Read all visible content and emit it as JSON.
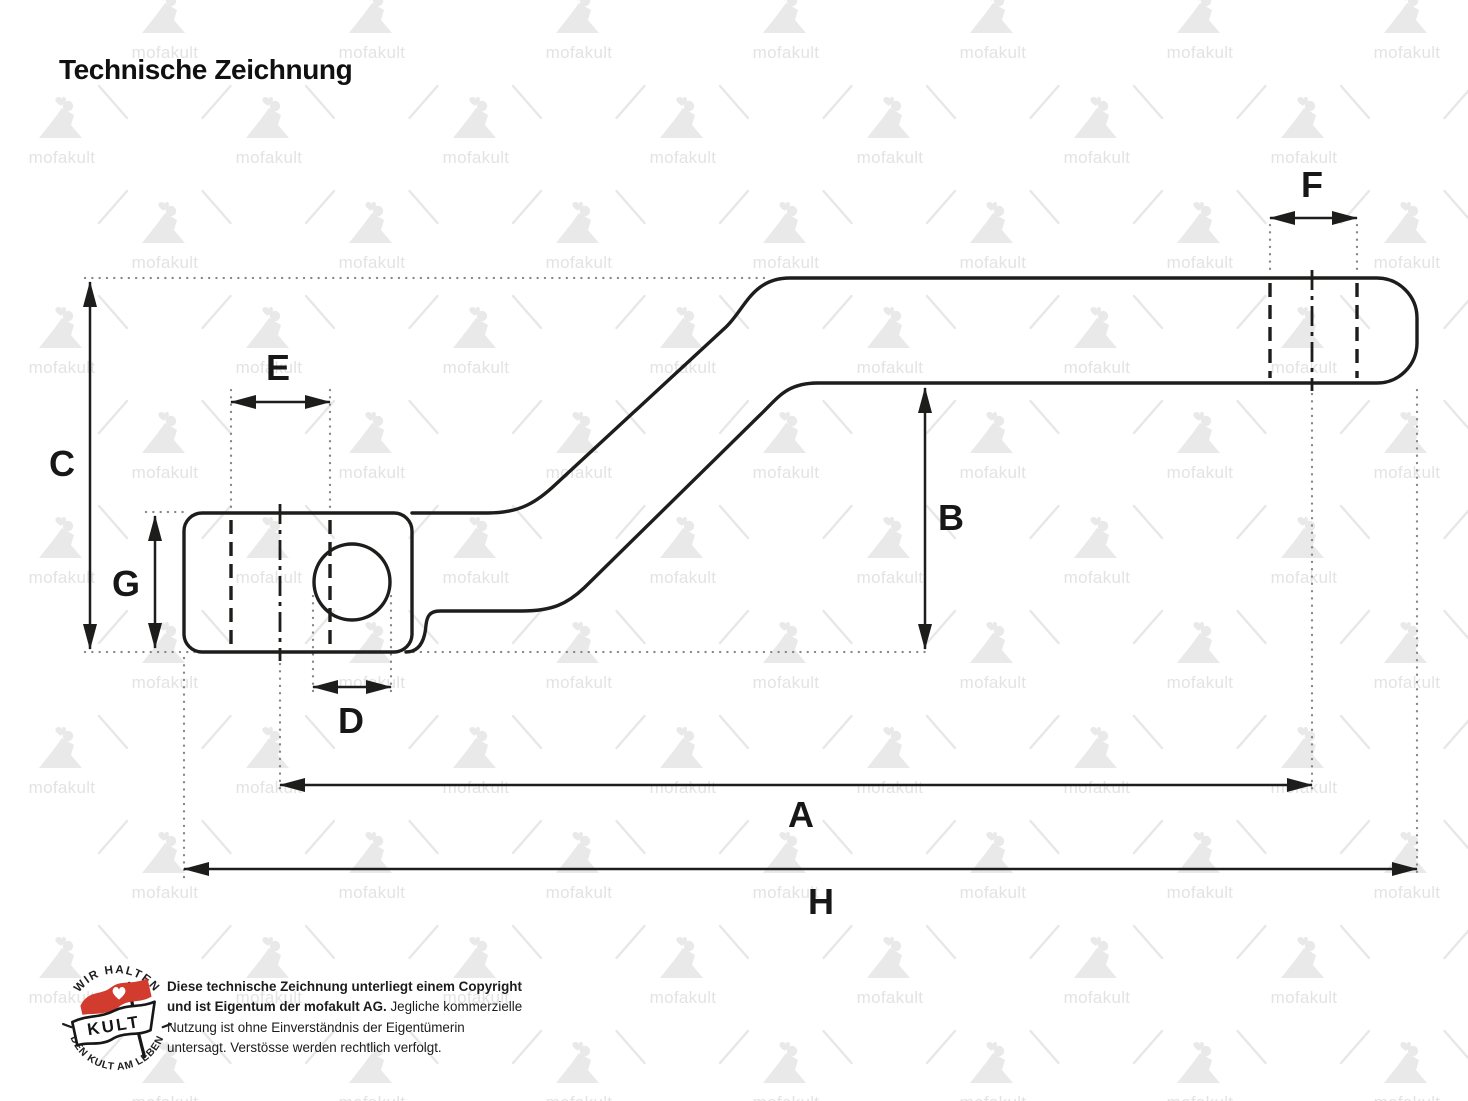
{
  "title": "Technische Zeichnung",
  "watermark": {
    "text": "mofakult"
  },
  "dims": {
    "A": "A",
    "B": "B",
    "C": "C",
    "D": "D",
    "E": "E",
    "F": "F",
    "G": "G",
    "H": "H"
  },
  "badge": {
    "top": "WIR HALTEN",
    "bottom": "DEN KULT AM LEBEN",
    "center": "KULT"
  },
  "copyright": {
    "bold": "Diese technische Zeichnung unterliegt einem Copyright und ist Eigentum der mofakult AG.",
    "regular": "Jegliche kommerzielle Nutzung ist ohne Einverständnis der Eigentümerin untersagt. Verstösse werden rechtlich verfolgt."
  },
  "colors": {
    "ink": "#1d1d1b",
    "construction_gray": "#868686",
    "watermark_gray": "#e3e3e3",
    "badge_red": "#d13c2e"
  }
}
